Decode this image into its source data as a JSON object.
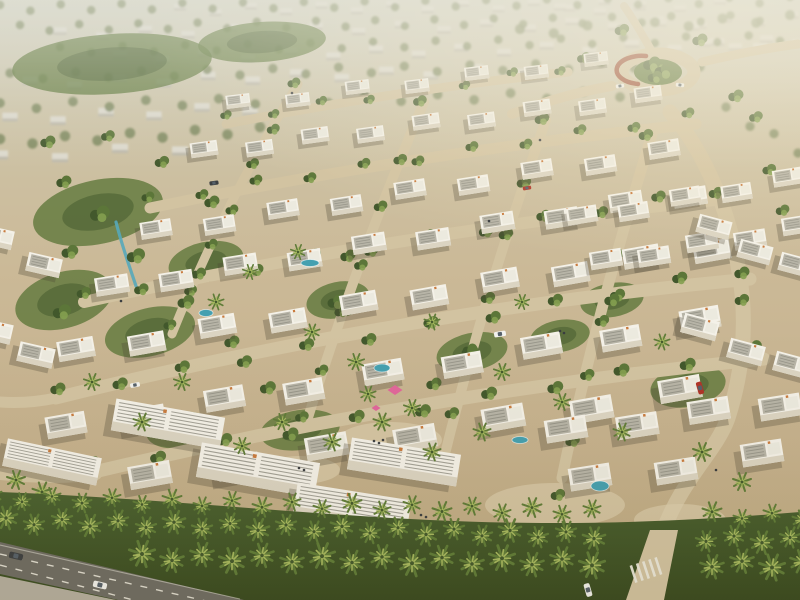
{
  "meta": {
    "title": "Aerial rendering of a master-planned villa community with white townhouses, palm-lined boulevard, sandy streets, parks and a landscaped roundabout",
    "canvas": {
      "width": 800,
      "height": 600
    }
  },
  "palette": {
    "sand_path": "#d2c3a1",
    "sand_light": "#ddd0b0",
    "asphalt": "#6e6c64",
    "sidewalk": "#b5afa0",
    "lane": "#eceade",
    "villa_white": "#f4f1e8",
    "villa_face": "#dbd4c2",
    "roof_panel": "#b7b4a7",
    "roof_alt": "#eceadf",
    "roof_ridge": "#8f8d82",
    "chimney": "#c97b3e",
    "green_dark": "#42582c",
    "green_mid": "#5c7639",
    "green_light": "#84a050",
    "palm": "#5f7c38",
    "palm_light": "#a6b85f",
    "water": "#57a8ba",
    "pool": "#45a0b0",
    "canopy_pink": "#e0679b",
    "wall_red": "#9a4830",
    "car_white": "#f2f2ee",
    "car_dark": "#3c3f42",
    "car_red": "#b03428",
    "glass": "#55606a",
    "people": "#3a3d40",
    "distant_block": "#dedbd0",
    "distant_face": "#bcb8aa",
    "distant_tree": "#768258"
  },
  "scene": {
    "distant_house_rows": [
      [
        180,
        10,
        640,
        4,
        14,
        0.85
      ],
      [
        60,
        34,
        700,
        22,
        16,
        0.95
      ],
      [
        120,
        58,
        760,
        44,
        16,
        1.0
      ],
      [
        30,
        84,
        520,
        70,
        12,
        1.05
      ],
      [
        10,
        120,
        250,
        108,
        6,
        1.1
      ],
      [
        0,
        158,
        180,
        148,
        4,
        1.15
      ],
      [
        660,
        26,
        792,
        18,
        5,
        0.9
      ],
      [
        704,
        46,
        798,
        40,
        4,
        0.95
      ],
      [
        560,
        10,
        720,
        4,
        5,
        0.85
      ]
    ],
    "distant_tree_rows": [
      [
        0,
        8,
        790,
        0,
        27,
        1.0
      ],
      [
        20,
        28,
        760,
        18,
        26,
        1.0
      ],
      [
        60,
        50,
        780,
        38,
        24,
        1.0
      ],
      [
        10,
        76,
        700,
        64,
        22,
        1.1
      ],
      [
        0,
        106,
        620,
        94,
        18,
        1.15
      ],
      [
        0,
        142,
        260,
        130,
        9,
        1.25
      ],
      [
        520,
        32,
        790,
        18,
        9,
        1.2
      ],
      [
        726,
        110,
        798,
        150,
        4,
        1.1
      ]
    ],
    "park_blobs": [
      [
        98,
        212,
        66,
        32,
        -12
      ],
      [
        64,
        300,
        50,
        28,
        -16
      ],
      [
        150,
        332,
        46,
        24,
        -14
      ],
      [
        206,
        262,
        38,
        20,
        -12
      ],
      [
        338,
        300,
        32,
        18,
        -12
      ],
      [
        472,
        352,
        36,
        19,
        -12
      ],
      [
        612,
        300,
        32,
        17,
        -10
      ],
      [
        688,
        386,
        38,
        21,
        -10
      ],
      [
        112,
        64,
        100,
        30,
        -4
      ],
      [
        262,
        42,
        64,
        20,
        -4
      ],
      [
        560,
        336,
        30,
        16,
        -10
      ],
      [
        300,
        430,
        40,
        20,
        -8
      ],
      [
        180,
        430,
        34,
        18,
        -8
      ]
    ],
    "streets": [
      {
        "d": "M150 208 Q420 152 696 124",
        "w": 11
      },
      {
        "d": "M84 302 Q400 232 724 199",
        "w": 12
      },
      {
        "d": "M56 398 Q400 312 750 279",
        "w": 13
      },
      {
        "d": "M94 472 Q430 392 764 359",
        "w": 13
      },
      {
        "d": "M226 124 Q400 90 568 72",
        "w": 9
      },
      {
        "d": "M298 84 Q226 200 172 334",
        "w": 9
      },
      {
        "d": "M424 102 Q356 262 306 424",
        "w": 10
      },
      {
        "d": "M546 120 Q482 300 440 474",
        "w": 10
      },
      {
        "d": "M652 134 Q592 330 562 478",
        "w": 11
      },
      {
        "d": "M662 534 C682 478 716 452 728 418 C744 368 748 318 738 266 C728 206 702 148 670 112",
        "w": 15
      },
      {
        "d": "M612 86 C576 92 544 102 512 114",
        "w": 10
      },
      {
        "d": "M702 62 C736 54 768 48 798 44",
        "w": 9
      },
      {
        "d": "M650 48 C642 34 634 20 624 6",
        "w": 8
      },
      {
        "d": "M96 474 Q60 480 0 474",
        "w": 12
      },
      {
        "d": "M56 398 Q28 404 0 402",
        "w": 11
      }
    ],
    "plazas": [
      [
        555,
        505,
        70,
        22
      ],
      [
        390,
        440,
        52,
        18
      ],
      [
        300,
        470,
        40,
        14
      ],
      [
        680,
        520,
        46,
        16
      ]
    ],
    "water_channels": [
      {
        "d": "M116 222 C122 246 128 262 136 286",
        "w": 3.2
      }
    ],
    "tree_rows": [
      [
        148,
        200,
        688,
        116,
        11,
        0.85
      ],
      [
        84,
        296,
        716,
        190,
        12,
        0.95
      ],
      [
        58,
        392,
        742,
        270,
        12,
        1.0
      ],
      [
        92,
        466,
        754,
        350,
        11,
        1.05
      ],
      [
        226,
        118,
        560,
        68,
        8,
        0.75
      ],
      [
        294,
        86,
        170,
        328,
        7,
        0.85
      ],
      [
        420,
        104,
        302,
        420,
        7,
        0.9
      ],
      [
        542,
        122,
        434,
        468,
        7,
        0.95
      ],
      [
        646,
        138,
        558,
        498,
        7,
        0.95
      ],
      [
        756,
        120,
        796,
        260,
        4,
        0.9
      ]
    ],
    "tree_scatter": [
      [
        100,
        214,
        1.3
      ],
      [
        70,
        252,
        1.1
      ],
      [
        136,
        256,
        1.2
      ],
      [
        186,
        302,
        1.1
      ],
      [
        62,
        312,
        1.2
      ],
      [
        232,
        342,
        1.0
      ],
      [
        336,
        302,
        1.1
      ],
      [
        470,
        352,
        1.1
      ],
      [
        612,
        300,
        1.0
      ],
      [
        688,
        386,
        1.1
      ],
      [
        742,
        300,
        0.95
      ],
      [
        64,
        182,
        1.0
      ],
      [
        162,
        162,
        0.95
      ],
      [
        108,
        136,
        0.9
      ],
      [
        48,
        142,
        1.0
      ],
      [
        212,
        202,
        1.0
      ],
      [
        652,
        64,
        1.15
      ],
      [
        664,
        71,
        1.25
      ],
      [
        655,
        77,
        0.95
      ],
      [
        700,
        40,
        1.0
      ],
      [
        622,
        30,
        0.95
      ],
      [
        736,
        96,
        1.0
      ],
      [
        584,
        58,
        0.9
      ],
      [
        348,
        256,
        1.0
      ],
      [
        268,
        388,
        1.05
      ],
      [
        512,
        416,
        1.05
      ],
      [
        434,
        384,
        1.0
      ]
    ],
    "villa_rows": [
      [
        238,
        104,
        596,
        62,
        7,
        0.6,
        -7
      ],
      [
        204,
        152,
        648,
        97,
        9,
        0.68,
        -8
      ],
      [
        156,
        232,
        664,
        152,
        9,
        0.78,
        -9
      ],
      [
        112,
        288,
        690,
        194,
        10,
        0.84,
        -9
      ],
      [
        76,
        352,
        712,
        248,
        10,
        0.92,
        -10
      ],
      [
        66,
        428,
        700,
        322,
        9,
        1.0,
        -10
      ],
      [
        150,
        478,
        680,
        392,
        7,
        1.06,
        -10
      ],
      [
        582,
        218,
        788,
        180,
        5,
        0.76,
        -9
      ],
      [
        606,
        262,
        798,
        228,
        5,
        0.8,
        -9
      ],
      [
        714,
        230,
        796,
        268,
        3,
        0.84,
        15
      ],
      [
        700,
        330,
        792,
        368,
        3,
        0.9,
        15
      ],
      [
        -4,
        240,
        44,
        262,
        2,
        0.86,
        13
      ],
      [
        -6,
        334,
        36,
        352,
        2,
        0.9,
        13
      ],
      [
        566,
        432,
        780,
        404,
        4,
        1.04,
        -9
      ],
      [
        590,
        480,
        762,
        456,
        3,
        1.04,
        -9
      ]
    ],
    "strips": [
      [
        168,
        424,
        1.15,
        10
      ],
      [
        258,
        470,
        1.25,
        10
      ],
      [
        404,
        462,
        1.15,
        9
      ],
      [
        52,
        462,
        1.0,
        12
      ],
      [
        352,
        508,
        1.2,
        9
      ]
    ],
    "palm_scatter": [
      [
        250,
        272,
        0.8
      ],
      [
        312,
        332,
        0.85
      ],
      [
        356,
        362,
        0.9
      ],
      [
        298,
        252,
        0.8
      ],
      [
        216,
        302,
        0.85
      ],
      [
        432,
        322,
        0.85
      ],
      [
        502,
        372,
        0.9
      ],
      [
        562,
        402,
        0.9
      ],
      [
        622,
        432,
        0.95
      ],
      [
        382,
        422,
        0.95
      ],
      [
        432,
        452,
        0.95
      ],
      [
        182,
        382,
        0.9
      ],
      [
        142,
        422,
        0.95
      ],
      [
        522,
        302,
        0.8
      ],
      [
        662,
        342,
        0.85
      ],
      [
        702,
        452,
        1.0
      ],
      [
        742,
        482,
        1.0
      ],
      [
        92,
        382,
        0.9
      ],
      [
        482,
        432,
        0.95
      ],
      [
        282,
        422,
        0.9
      ],
      [
        332,
        442,
        0.95
      ],
      [
        242,
        446,
        0.9
      ],
      [
        16,
        480,
        1.0
      ],
      [
        42,
        492,
        1.05
      ],
      [
        8,
        516,
        1.1
      ],
      [
        58,
        522,
        1.0
      ],
      [
        368,
        394,
        0.85
      ],
      [
        412,
        408,
        0.9
      ]
    ],
    "palm_band_rows": [
      [
        -8,
        497,
        808,
        516,
        30,
        0.95,
        614,
        694
      ],
      [
        6,
        520,
        812,
        540,
        28,
        1.12,
        612,
        696
      ],
      [
        142,
        556,
        812,
        564,
        30,
        1.28,
        606,
        700
      ]
    ],
    "pools": [
      [
        382,
        368,
        8,
        4
      ],
      [
        600,
        486,
        9,
        5
      ],
      [
        206,
        313,
        7,
        3.5
      ],
      [
        310,
        263,
        9,
        3.5
      ],
      [
        520,
        440,
        8,
        3.5
      ]
    ],
    "canopies": [
      [
        395,
        390,
        1
      ],
      [
        376,
        408,
        0.6
      ]
    ],
    "people": [
      [
        374,
        441
      ],
      [
        379,
        443
      ],
      [
        383,
        440
      ],
      [
        299,
        468
      ],
      [
        304,
        470
      ],
      [
        560,
        331
      ],
      [
        564,
        333
      ],
      [
        121,
        301
      ],
      [
        180,
        506
      ],
      [
        185,
        508
      ],
      [
        421,
        515
      ],
      [
        426,
        517
      ],
      [
        716,
        470
      ],
      [
        292,
        93
      ],
      [
        489,
        221
      ],
      [
        540,
        140
      ]
    ],
    "cars_inner": [
      [
        500,
        334,
        -9,
        0.85,
        "car_white"
      ],
      [
        700,
        388,
        74,
        0.9,
        "car_red"
      ],
      [
        620,
        86,
        -8,
        0.6,
        "car_white"
      ],
      [
        680,
        85,
        6,
        0.6,
        "car_white"
      ],
      [
        214,
        183,
        -8,
        0.65,
        "car_dark"
      ],
      [
        527,
        188,
        -9,
        0.6,
        "car_red"
      ],
      [
        135,
        385,
        -10,
        0.7,
        "car_white"
      ]
    ],
    "cars_road": [
      [
        16,
        556,
        13,
        1,
        "car_dark"
      ],
      [
        100,
        585,
        13,
        1,
        "car_white"
      ],
      [
        588,
        590,
        74,
        0.95,
        "car_white"
      ]
    ]
  }
}
